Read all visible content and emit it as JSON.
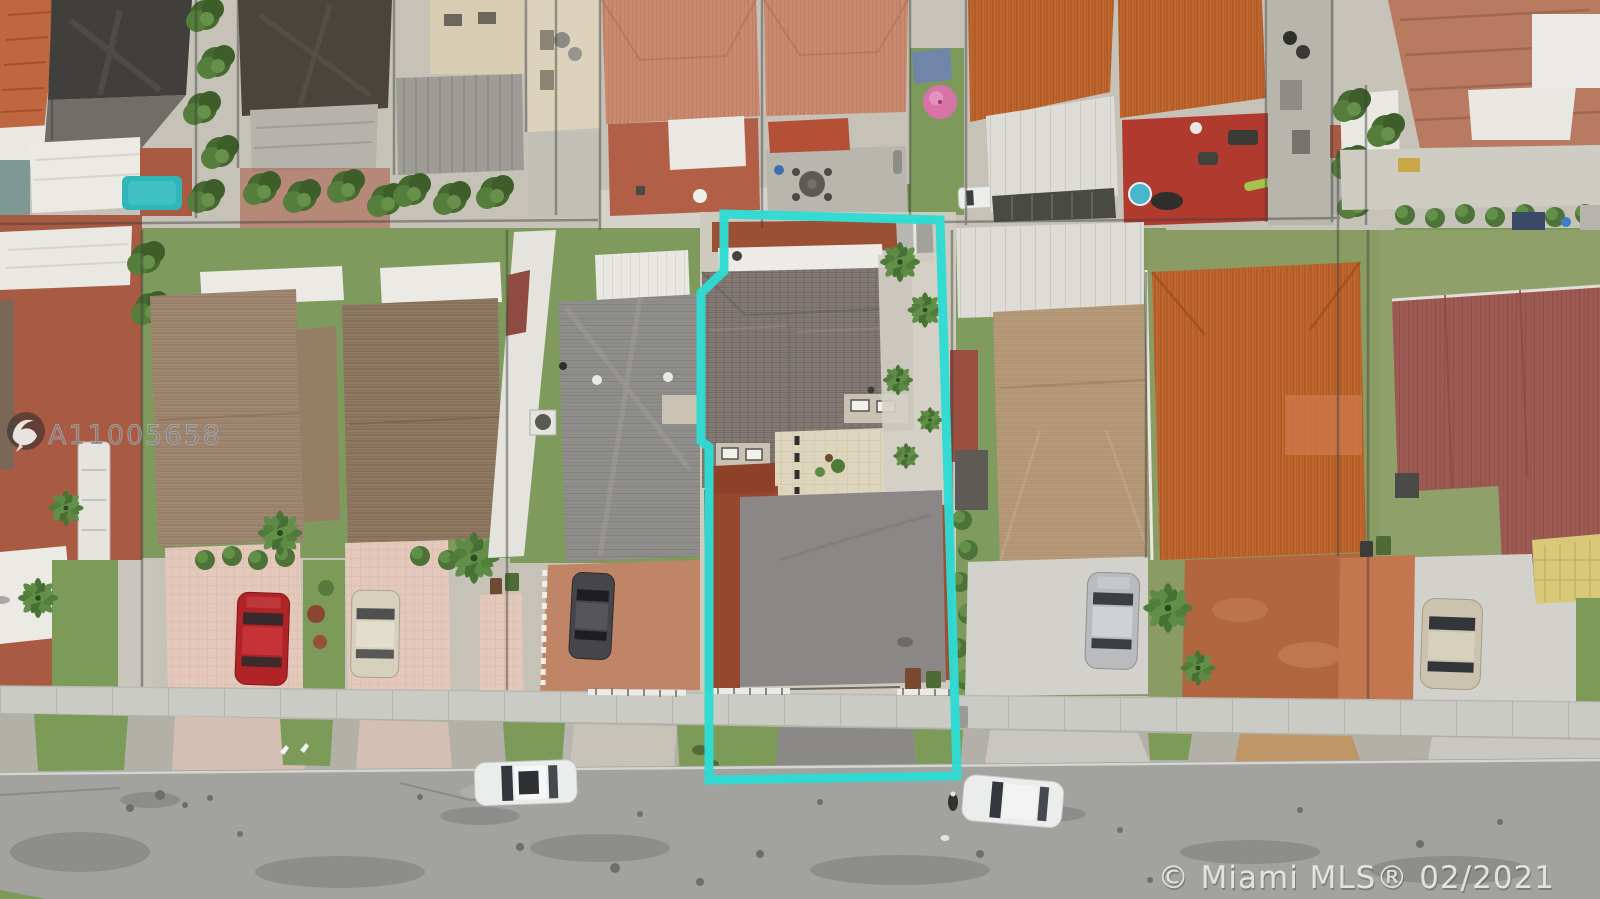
{
  "overlays": {
    "mls_number": "A11005658",
    "copyright_text": "© Miami MLS® 02/2021",
    "logo": "mls-bird-logo"
  },
  "property_boundary": {
    "color": "#2edbd3",
    "stroke_width": 9,
    "shape": "polygon outline around subject lot with jogged left edge"
  },
  "palette": {
    "boundary_cyan": "#2edbd3",
    "street": "#a2a29f",
    "street_dark_patch": "#8d8d8b",
    "sidewalk": "#cbcbc5",
    "parkway": "#b2b0a7",
    "grass": "#7c9a58",
    "asphalt_driveway": "#8b8786",
    "mulch_red": "#97472e",
    "terracotta_ground": "#a85a43",
    "pink_driveway": "#e4c8bb",
    "terra_driveway": "#c08467",
    "concrete_driveway": "#d2d1cb",
    "dirt_driveway": "#b2663f",
    "subject_roof": "#847b76",
    "pool_teal": "#2fb6b9",
    "umbrella_pink": "#d873a8",
    "car_red": "#b02326",
    "car_beige": "#d6d0bd",
    "car_dark": "#46464a",
    "car_silver": "#b9bbbd",
    "car_tan": "#cbc3ae",
    "car_white": "#ebedec"
  },
  "scene": {
    "type": "aerial-drone-photo",
    "subject": "residential lot outlined in cyan, dark shingle roof house with large asphalt pad",
    "vehicles": [
      "red car in pink driveway",
      "beige car in pink driveway",
      "dark gray car in terracotta driveway",
      "silver car in concrete driveway",
      "tan car in right concrete driveway",
      "white sedan parked on street left",
      "white sedan parked on street right"
    ]
  }
}
